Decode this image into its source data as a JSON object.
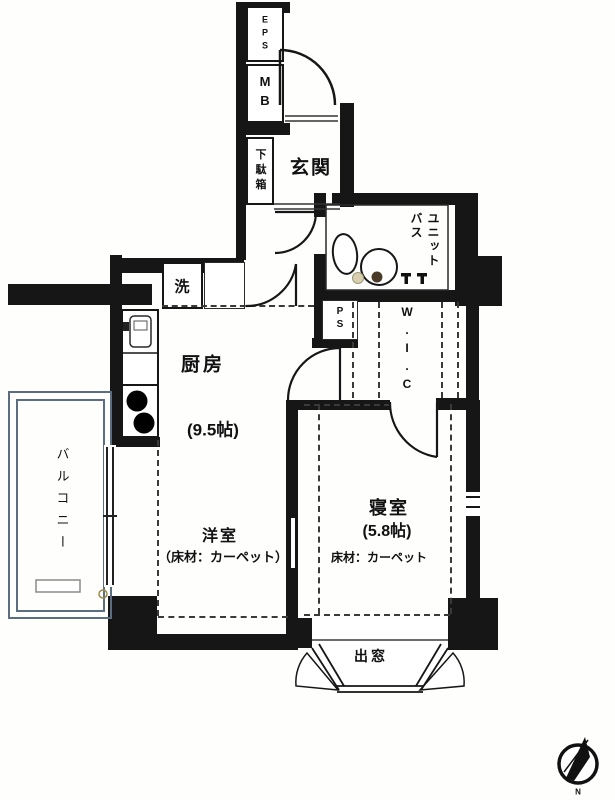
{
  "rooms": {
    "eps": {
      "label": "EPS"
    },
    "mb": {
      "label": "MB"
    },
    "genkan": {
      "label": "玄関"
    },
    "shoe_box": {
      "label": "下駄箱"
    },
    "unit_bath": {
      "label": "ユニット\nバス"
    },
    "washer": {
      "label": "洗"
    },
    "pipe_space": {
      "label": "PS"
    },
    "wic": {
      "label": "W.I.C"
    },
    "kitchen": {
      "label": "厨房",
      "size": "(9.5帖)"
    },
    "living": {
      "label": "洋室",
      "floor_note": "（床材：カーペット）"
    },
    "bedroom": {
      "label": "寝室",
      "size": "(5.8帖)",
      "floor_note": "床材：カーペット"
    },
    "balcony": {
      "label": "バルコニー"
    },
    "bay_window": {
      "label": "出窓"
    },
    "compass": {
      "label": "N"
    }
  },
  "colors": {
    "wall": "#161616",
    "line": "#222222",
    "dash": "#3a3a3a",
    "balcony_rail": "#5b6d80",
    "background": "#ffffff"
  }
}
